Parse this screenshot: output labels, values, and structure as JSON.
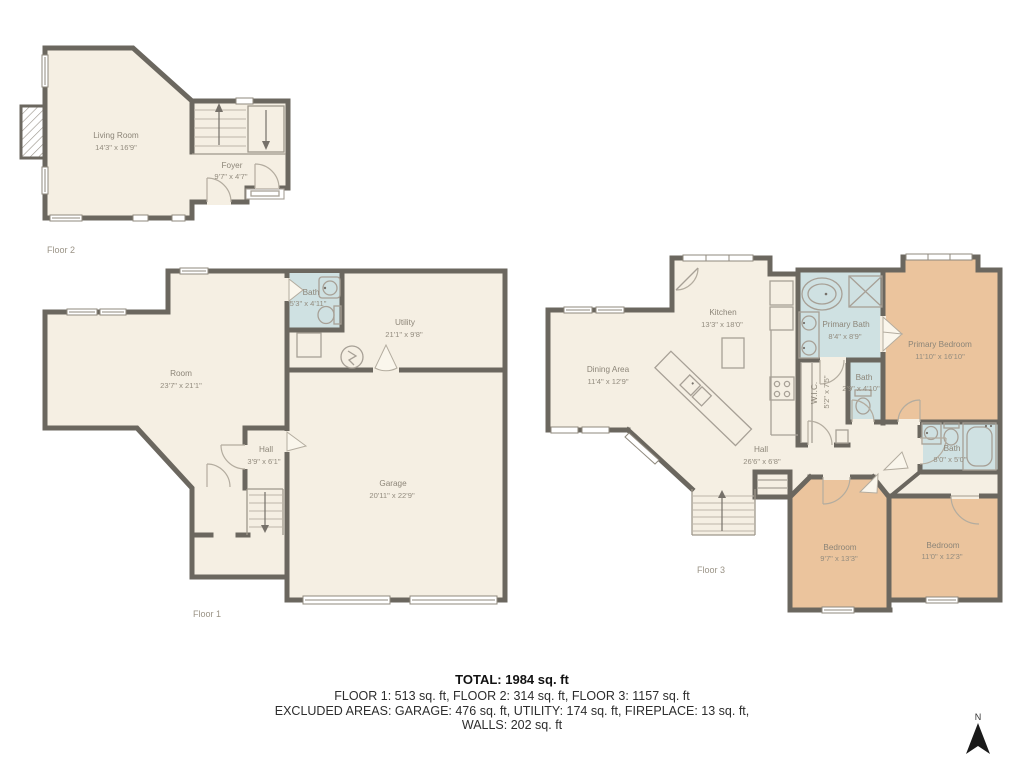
{
  "colors": {
    "wall": "#6b675f",
    "floor": "#f5efe3",
    "bath": "#cfe1e2",
    "bedroom": "#ebc49d",
    "label_text": "#8c8578",
    "summary_text": "#2d2d2d"
  },
  "floor2": {
    "label": "Floor 2",
    "living_room": {
      "name": "Living Room",
      "dims": "14'3\" x 16'9\""
    },
    "foyer": {
      "name": "Foyer",
      "dims": "9'7\" x 4'7\""
    }
  },
  "floor1": {
    "label": "Floor 1",
    "room": {
      "name": "Room",
      "dims": "23'7\" x 21'1\""
    },
    "bath": {
      "name": "Bath",
      "dims": "5'3\" x 4'11\""
    },
    "utility": {
      "name": "Utility",
      "dims": "21'1\" x 9'8\""
    },
    "hall": {
      "name": "Hall",
      "dims": "3'9\" x 6'1\""
    },
    "garage": {
      "name": "Garage",
      "dims": "20'11\" x 22'9\""
    }
  },
  "floor3": {
    "label": "Floor 3",
    "dining": {
      "name": "Dining Area",
      "dims": "11'4\" x 12'9\""
    },
    "kitchen": {
      "name": "Kitchen",
      "dims": "13'3\" x 18'0\""
    },
    "primary_bath": {
      "name": "Primary Bath",
      "dims": "8'4\" x 8'9\""
    },
    "primary_bedroom": {
      "name": "Primary Bedroom",
      "dims": "11'10\" x 16'10\""
    },
    "wic": {
      "name": "W.I.C.",
      "dims": "5'2\" x 7'5\""
    },
    "small_bath": {
      "name": "Bath",
      "dims": "2'9\" x 4'10\""
    },
    "hall": {
      "name": "Hall",
      "dims": "26'6\" x 6'8\""
    },
    "bath": {
      "name": "Bath",
      "dims": "8'0\" x 5'0\""
    },
    "bedroom1": {
      "name": "Bedroom",
      "dims": "9'7\" x 13'3\""
    },
    "bedroom2": {
      "name": "Bedroom",
      "dims": "11'0\" x 12'3\""
    }
  },
  "summary": {
    "total": "TOTAL: 1984 sq. ft",
    "floors": "FLOOR 1: 513 sq. ft, FLOOR 2: 314 sq. ft, FLOOR 3: 1157 sq. ft",
    "excluded": "EXCLUDED AREAS: GARAGE: 476 sq. ft, UTILITY: 174 sq. ft, FIREPLACE: 13 sq. ft,",
    "walls": "WALLS: 202 sq. ft"
  },
  "compass": {
    "north_label": "N"
  }
}
